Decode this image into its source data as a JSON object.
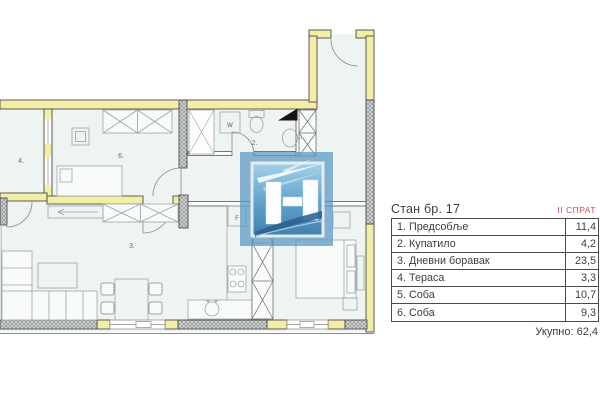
{
  "plan": {
    "room_labels": {
      "bathroom": "2.",
      "living_room": "3.",
      "terrace": "4.",
      "bedroom_large": "6.",
      "washer": "W",
      "fridge": "F"
    },
    "colors": {
      "wall_fill": "#f3eda6",
      "floor_fill": "#edf4f2",
      "hatch_fill": "#d6d8d8",
      "logo_blue": "#4f8fc0",
      "accent_red": "#c4524e"
    }
  },
  "panel": {
    "title": "Стан бр. 17",
    "floor": "II СПРАТ",
    "rows": [
      {
        "label": "1. Предсобље",
        "value": "11,4"
      },
      {
        "label": "2. Купатило",
        "value": "4,2"
      },
      {
        "label": "3. Дневни боравак",
        "value": "23,5"
      },
      {
        "label": "4. Тераса",
        "value": "3,3"
      },
      {
        "label": "5. Соба",
        "value": "10,7"
      },
      {
        "label": "6. Соба",
        "value": "9,3"
      }
    ],
    "total": "Укупно: 62,4"
  }
}
